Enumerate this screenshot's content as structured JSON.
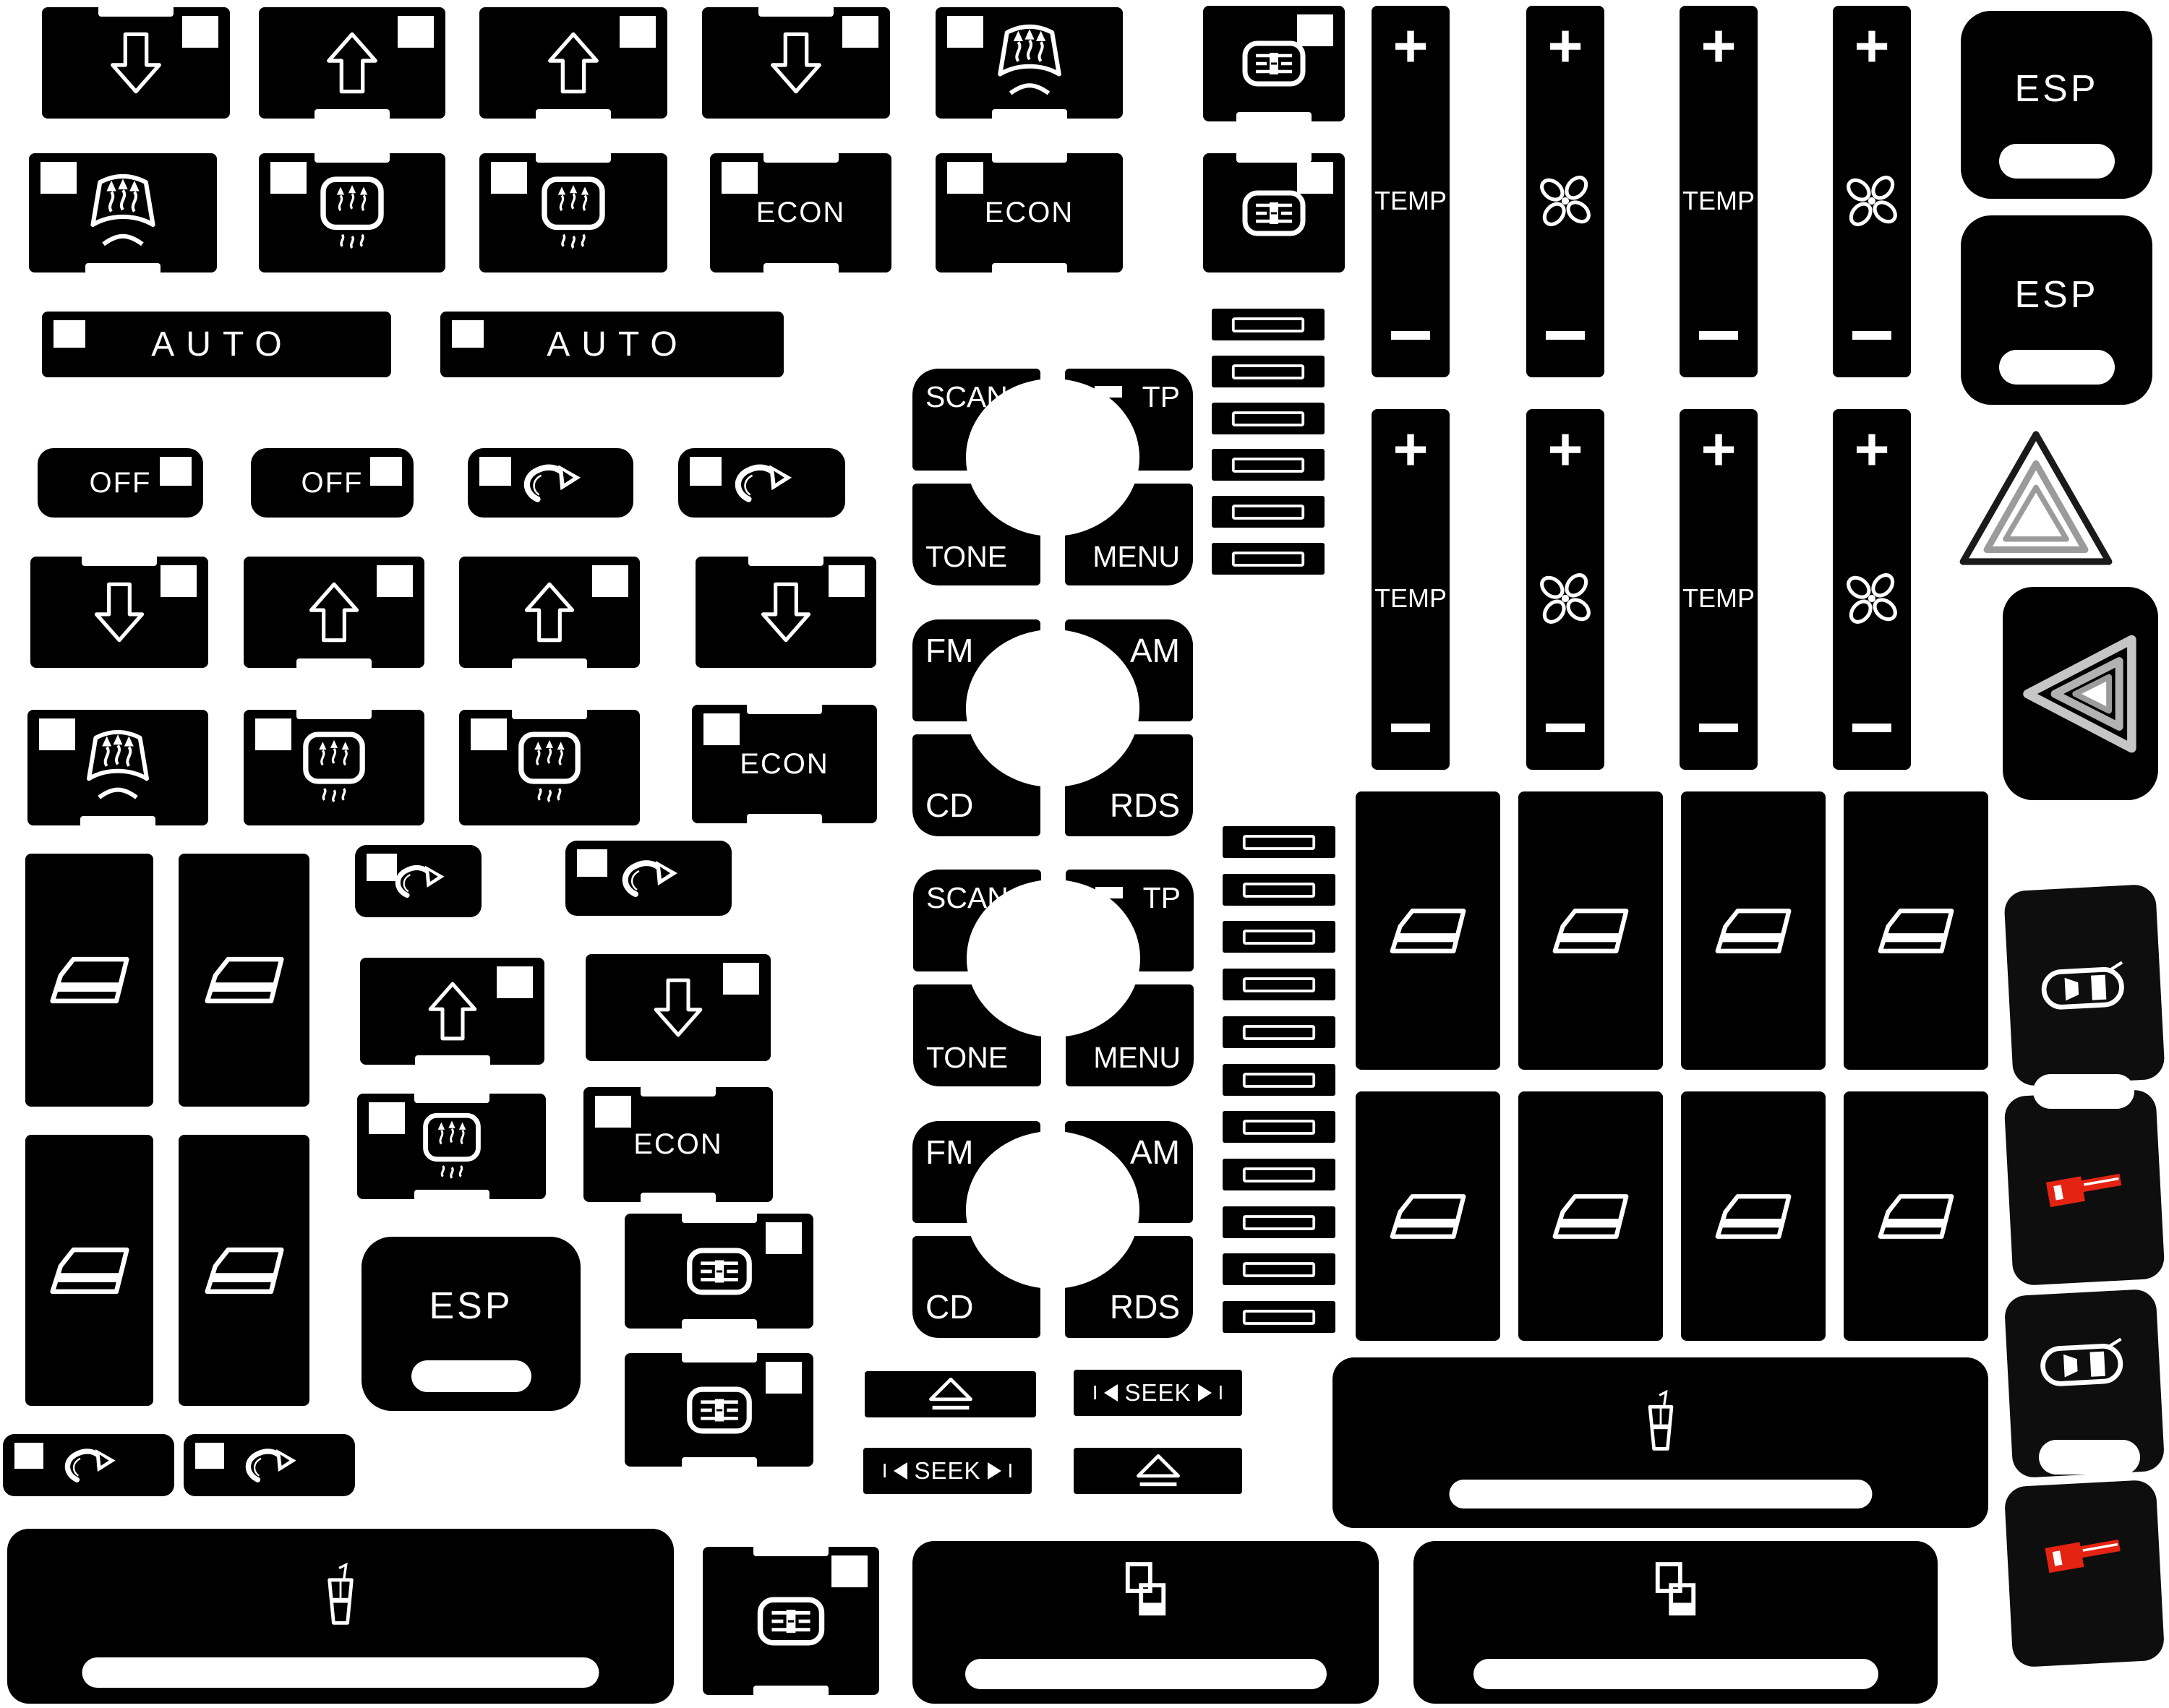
{
  "title": "Dashboard button decal sheet",
  "colors": {
    "background": "#ffffff",
    "button": "#000000",
    "symbol": "#ffffff",
    "lock_red": "#e42313",
    "hazard_gray": "#9b9b9b"
  },
  "labels": {
    "auto": "AUTO",
    "off": "OFF",
    "econ": "ECON",
    "esp": "ESP",
    "temp": "TEMP",
    "plus": "+",
    "minus": "−",
    "scan": "SCAN",
    "tp": "TP",
    "tone": "TONE",
    "menu": "MENU",
    "fm": "FM",
    "am": "AM",
    "cd": "CD",
    "rds": "RDS",
    "seek": "SEEK",
    "seek_bar": "I"
  },
  "icons": {
    "arrow_up": "arrow-up-icon",
    "arrow_down": "arrow-down-icon",
    "windshield_defrost": "windshield-defrost-icon",
    "rear_defrost": "rear-window-defrost-icon",
    "vent_slot": "recirculation-vent-icon",
    "fan": "fan-icon",
    "recirculation_arrow": "recirculation-arrow-icon",
    "window_lifter": "window-lifter-icon",
    "car_lock": "car-central-lock-icon",
    "red_key": "red-lock-key-icon",
    "cup_holder": "cup-holder-icon",
    "window_stack": "sliding-cover-icon",
    "eject": "eject-icon",
    "hazard_triangle": "hazard-triangle-icon",
    "blank_slot": "blank-slot-icon"
  },
  "inventory": {
    "blank_slot_buttons": 17,
    "window_lifter_buttons": 12,
    "temp_fan_sliders": 8,
    "esp_buttons": 3,
    "radio_quad_groups": 4,
    "seek_buttons": 2,
    "eject_buttons": 2,
    "cup_holder_bars": 2,
    "sliding_cover_bars": 2,
    "door_lock_buttons": 4
  }
}
